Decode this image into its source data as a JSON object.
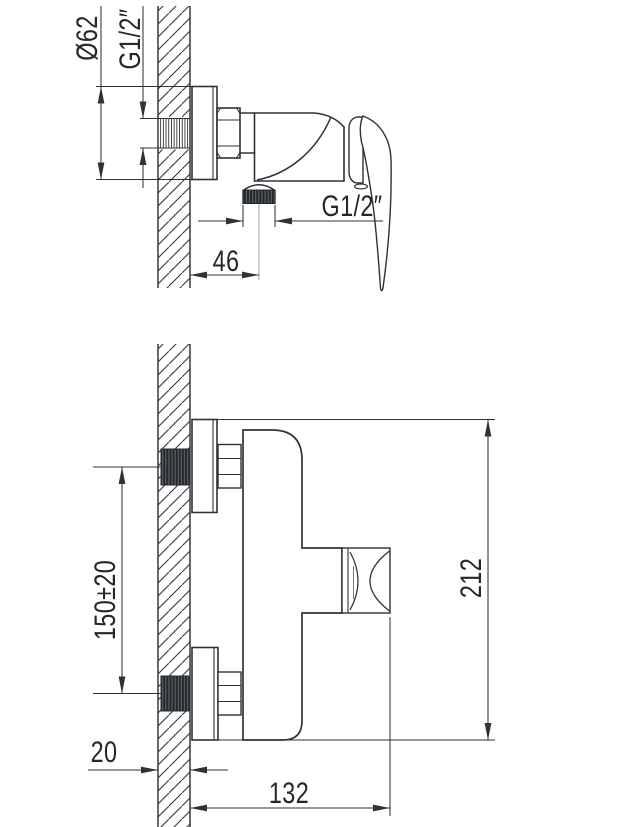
{
  "drawing": {
    "background": "#ffffff",
    "line_color": "#2e3338",
    "side_view": {
      "flange_diameter": "Ø62",
      "inlet_thread": "G1/2″",
      "outlet_thread": "G1/2″",
      "outlet_offset_from_wall": "46"
    },
    "front_view": {
      "inlet_center_distance": "150±20",
      "overall_height": "212",
      "wall_thickness": "20",
      "overall_width": "132"
    }
  }
}
